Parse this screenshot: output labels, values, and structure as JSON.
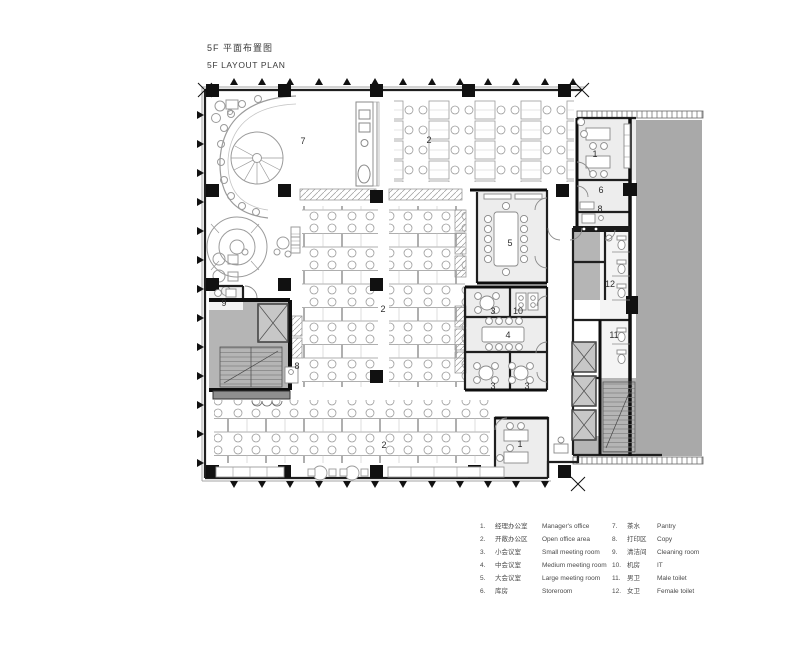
{
  "title": {
    "zh": "5F 平面布置图",
    "en": "5F LAYOUT PLAN"
  },
  "plan": {
    "room_labels": [
      {
        "room": "pantry",
        "text": "7"
      },
      {
        "room": "open-office-top",
        "text": "2"
      },
      {
        "room": "managers-office-top",
        "text": "1"
      },
      {
        "room": "storeroom",
        "text": "6"
      },
      {
        "room": "copy-right",
        "text": "8"
      },
      {
        "room": "large-meeting-room",
        "text": "5"
      },
      {
        "room": "female-toilet",
        "text": "12"
      },
      {
        "room": "small-meeting-upper",
        "text": "3"
      },
      {
        "room": "it-room",
        "text": "10"
      },
      {
        "room": "medium-meeting-room",
        "text": "4"
      },
      {
        "room": "small-meeting-lower-left",
        "text": "3"
      },
      {
        "room": "small-meeting-lower-right",
        "text": "3"
      },
      {
        "room": "male-toilet",
        "text": "11"
      },
      {
        "room": "cleaning-room",
        "text": "9"
      },
      {
        "room": "copy-left",
        "text": "8"
      },
      {
        "room": "open-office-mid",
        "text": "2"
      },
      {
        "room": "open-office-bottom",
        "text": "2"
      },
      {
        "room": "managers-office-bottom",
        "text": "1"
      }
    ]
  },
  "legend": {
    "items": [
      {
        "num": "1.",
        "zh": "经理办公室",
        "en": "Manager's office"
      },
      {
        "num": "2.",
        "zh": "开敞办公区",
        "en": "Open office area"
      },
      {
        "num": "3.",
        "zh": "小会议室",
        "en": "Small meeting room"
      },
      {
        "num": "4.",
        "zh": "中会议室",
        "en": "Medium meeting room"
      },
      {
        "num": "5.",
        "zh": "大会议室",
        "en": "Large meeting room"
      },
      {
        "num": "6.",
        "zh": "库房",
        "en": "Storeroom"
      },
      {
        "num": "7.",
        "zh": "茶水",
        "en": "Pantry"
      },
      {
        "num": "8.",
        "zh": "打印区",
        "en": "Copy"
      },
      {
        "num": "9.",
        "zh": "清洁间",
        "en": "Cleaning room"
      },
      {
        "num": "10.",
        "zh": "机房",
        "en": "IT"
      },
      {
        "num": "11.",
        "zh": "男卫",
        "en": "Male toilet"
      },
      {
        "num": "12.",
        "zh": "女卫",
        "en": "Female toilet"
      }
    ]
  },
  "colors": {
    "wall": "#1f1f1f",
    "room_fill": "#ededed",
    "core_fill": "#b5b5b5",
    "neighbor_fill": "#a9a9a9",
    "furniture_line": "#9b9b9b"
  }
}
